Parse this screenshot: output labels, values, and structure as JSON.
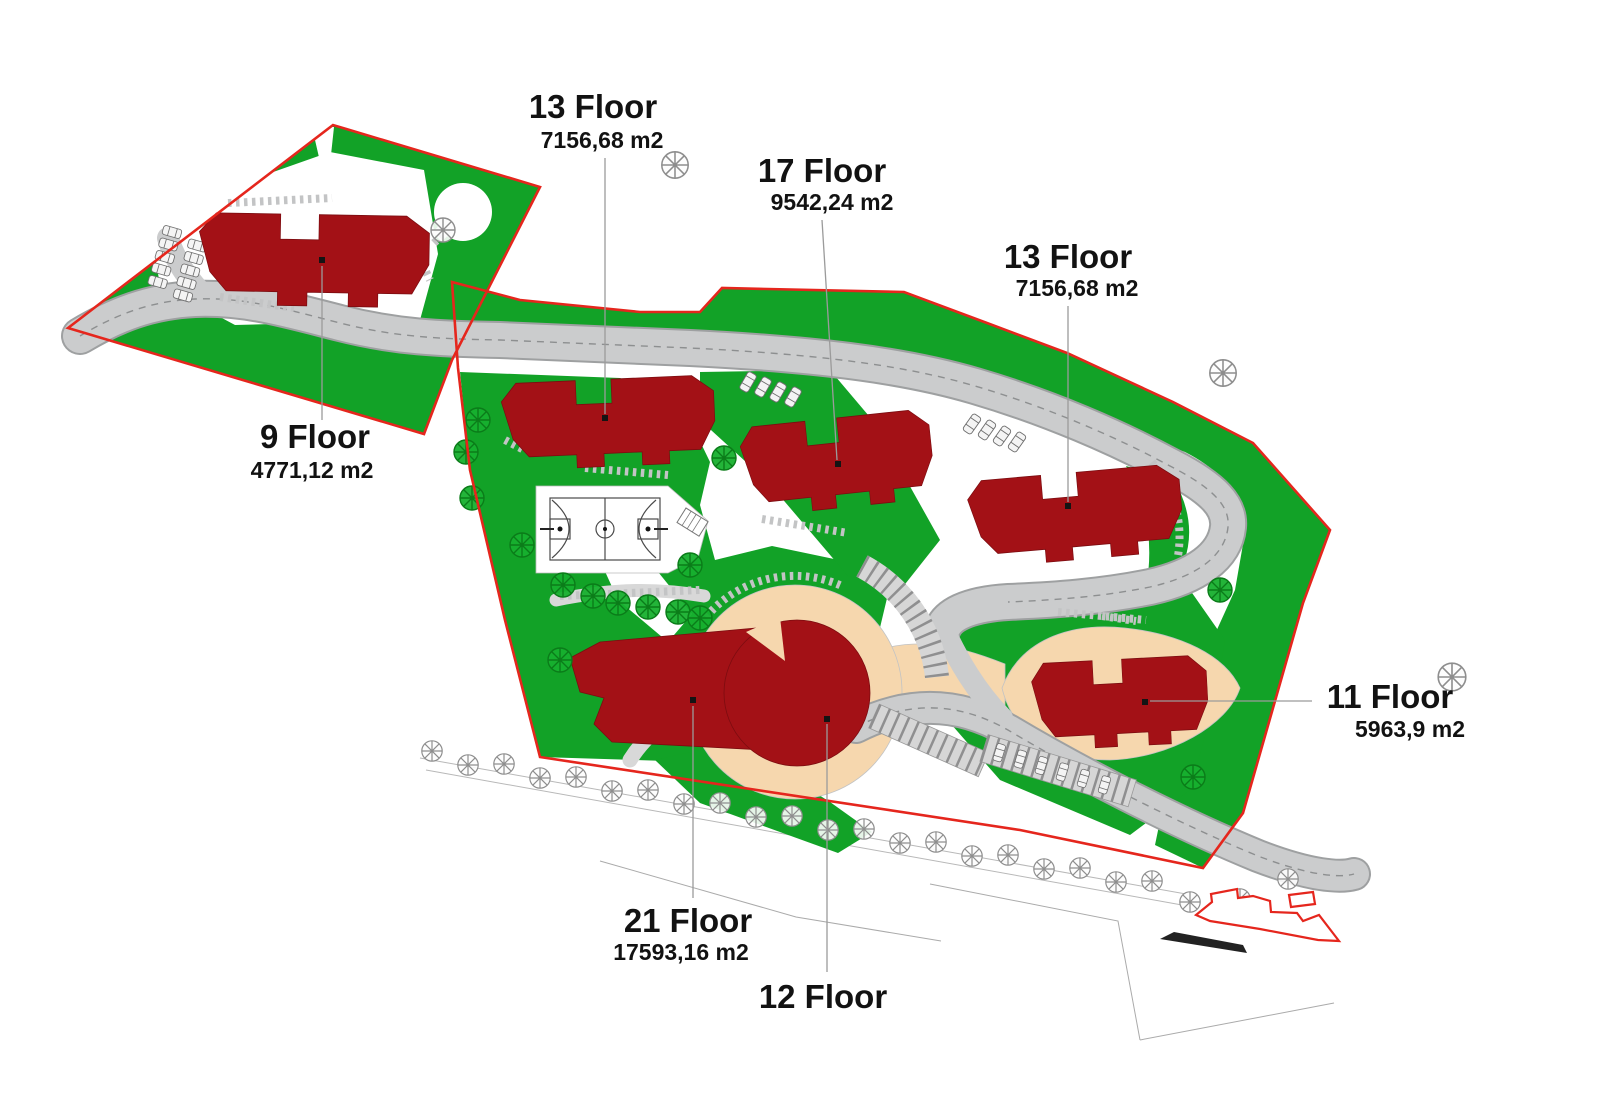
{
  "buildings": [
    {
      "id": "building-13-floor-west",
      "floor": "13 Floor",
      "area": "7156,68 m2"
    },
    {
      "id": "building-17-floor",
      "floor": "17 Floor",
      "area": "9542,24 m2"
    },
    {
      "id": "building-13-floor-east",
      "floor": "13 Floor",
      "area": "7156,68 m2"
    },
    {
      "id": "building-9-floor",
      "floor": "9 Floor",
      "area": "4771,12 m2"
    },
    {
      "id": "building-11-floor",
      "floor": "11 Floor",
      "area": "5963,9 m2"
    },
    {
      "id": "building-21-floor",
      "floor": "21 Floor",
      "area": "17593,16 m2"
    },
    {
      "id": "building-12-floor",
      "floor": "12 Floor",
      "area": ""
    }
  ],
  "colors": {
    "site_boundary": "#e5261d",
    "building": "#a31116",
    "lawn": "#12a227",
    "dark_tree": "#0b7c19",
    "road": "#cbcccd",
    "plaza_beige": "#f6d7ae",
    "label_text": "#121212"
  }
}
